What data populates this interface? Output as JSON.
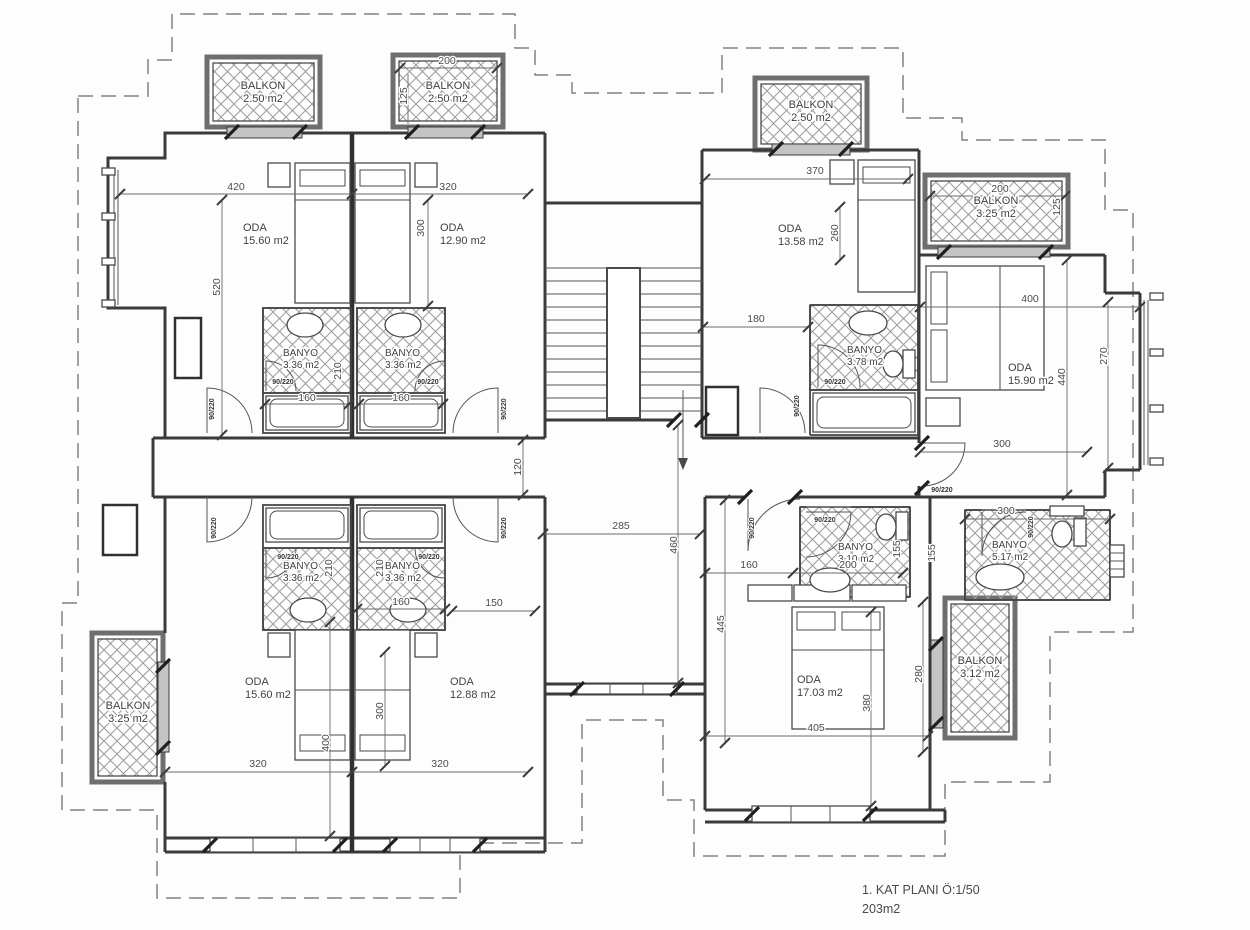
{
  "title": {
    "line1": "1. KAT PLANI Ö:1/50",
    "line2": "203m2"
  },
  "door_label": "90/220",
  "rooms": {
    "balkon_tl1": {
      "name": "BALKON",
      "area": "2.50 m2"
    },
    "balkon_tl2": {
      "name": "BALKON",
      "area": "2.50 m2"
    },
    "balkon_tr1": {
      "name": "BALKON",
      "area": "2.50 m2"
    },
    "balkon_tr2": {
      "name": "BALKON",
      "area": "3.25 m2"
    },
    "balkon_bl": {
      "name": "BALKON",
      "area": "3.25 m2"
    },
    "balkon_br": {
      "name": "BALKON",
      "area": "3.12 m2"
    },
    "oda_tl1": {
      "name": "ODA",
      "area": "15.60 m2"
    },
    "oda_tl2": {
      "name": "ODA",
      "area": "12.90 m2"
    },
    "oda_tr1": {
      "name": "ODA",
      "area": "13.58 m2"
    },
    "oda_tr2": {
      "name": "ODA",
      "area": "15.90 m2"
    },
    "oda_bl1": {
      "name": "ODA",
      "area": "15.60 m2"
    },
    "oda_bl2": {
      "name": "ODA",
      "area": "12.88 m2"
    },
    "oda_br": {
      "name": "ODA",
      "area": "17.03 m2"
    },
    "banyo_tl1": {
      "name": "BANYO",
      "area": "3.36 m2"
    },
    "banyo_tl2": {
      "name": "BANYO",
      "area": "3.36 m2"
    },
    "banyo_tr": {
      "name": "BANYO",
      "area": "3.78 m2"
    },
    "banyo_bl1": {
      "name": "BANYO",
      "area": "3.36 m2"
    },
    "banyo_bl2": {
      "name": "BANYO",
      "area": "3.36 m2"
    },
    "banyo_br1": {
      "name": "BANYO",
      "area": "3.10 m2"
    },
    "banyo_br2": {
      "name": "BANYO",
      "area": "5.17 m2"
    }
  },
  "dims": {
    "a420": "420",
    "a320": "320",
    "a300": "300",
    "a520": "520",
    "a200": "200",
    "a125": "125",
    "a160a": "160",
    "a160b": "160",
    "a210": "210",
    "b370": "370",
    "b260": "260",
    "b200": "200",
    "b125": "125",
    "b180": "180",
    "b400": "400",
    "b440": "440",
    "b270": "270",
    "b300": "300",
    "c285": "285",
    "c460": "460",
    "c120": "120",
    "c150": "150",
    "d160": "160",
    "d210a": "210",
    "d210b": "210",
    "d300": "300",
    "d400": "400",
    "d320a": "320",
    "d320b": "320",
    "e445": "445",
    "e160": "160",
    "e200": "200",
    "e155a": "155",
    "e155b": "155",
    "e300": "300",
    "e380": "380",
    "e280": "280",
    "e405": "405"
  }
}
